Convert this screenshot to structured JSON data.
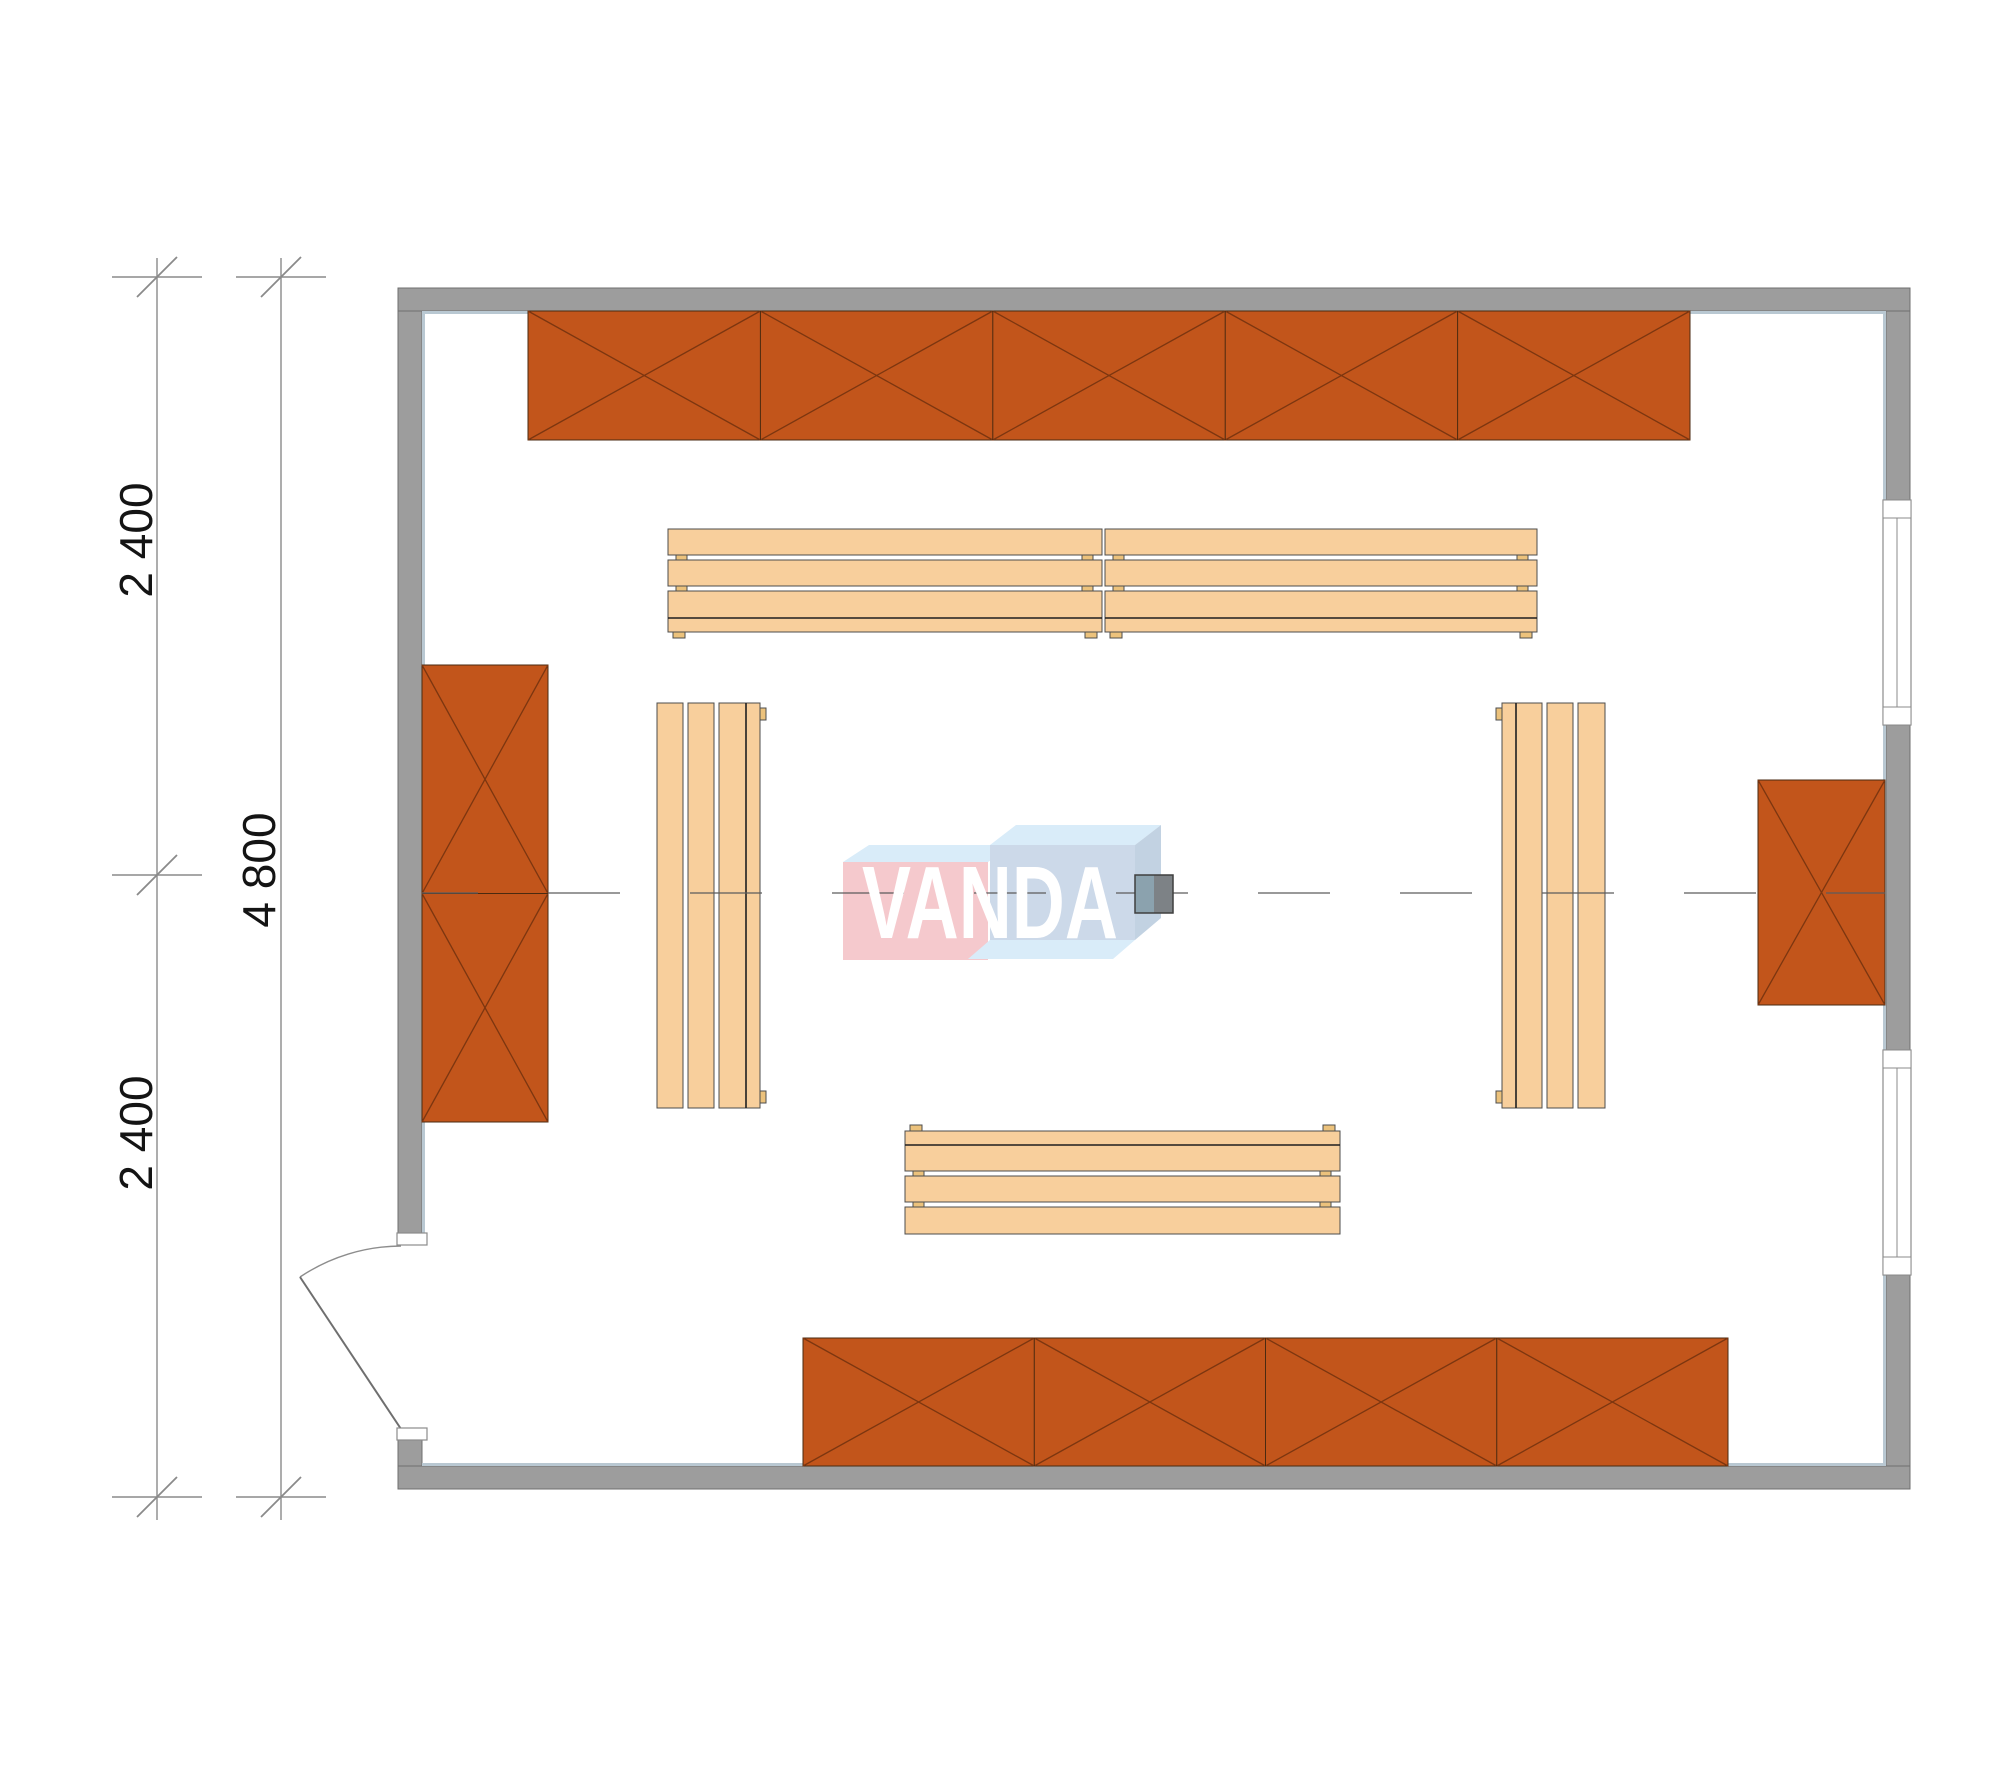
{
  "drawing": {
    "type": "architectural-floor-plan",
    "dimensions": {
      "top_segment": "2 400",
      "bottom_segment": "2 400",
      "total": "4 800"
    },
    "watermark": {
      "text": "VANDA"
    },
    "colors": {
      "wall": "#9d9d9d",
      "wall-outline": "#6f6f6f",
      "wall-highlight": "#b9c8d2",
      "frame-line": "#8b8b8b",
      "shelf": "#c2551b",
      "shelf-line": "#7c3610",
      "shelf-edge": "#4a2a10",
      "bench": "#f8cf9c",
      "bench-edge": "#4d4d4d",
      "feet": "#ecc27c",
      "dim": "#8a8a8a",
      "ink": "#141414",
      "centerline": "#5c5c5c",
      "wm-pink": "#f5c9cd",
      "wm-blue": "#ccd9e9",
      "wm-top": "#d9ecf9",
      "wm-side": "#c2d2e2",
      "column-left": "#8ba2ae",
      "column-right": "#7d8286"
    },
    "elements": {
      "shelves": [
        {
          "name": "shelf-top-wall",
          "x": 528,
          "y": 311,
          "w": 1162,
          "h": 129,
          "sections": 5,
          "dir": "h"
        },
        {
          "name": "shelf-left-wall",
          "x": 422,
          "y": 665,
          "w": 126,
          "h": 457,
          "sections": 2,
          "dir": "v"
        },
        {
          "name": "shelf-right-wall",
          "x": 1758,
          "y": 780,
          "w": 127,
          "h": 225,
          "sections": 1,
          "dir": "v"
        },
        {
          "name": "shelf-bottom-wall",
          "x": 803,
          "y": 1338,
          "w": 925,
          "h": 128,
          "sections": 4,
          "dir": "h"
        }
      ],
      "benches": [
        {
          "name": "bench-top-left",
          "x": 668,
          "y": 529,
          "len": 434,
          "dir": "h",
          "rail": "end"
        },
        {
          "name": "bench-top-right",
          "x": 1105,
          "y": 529,
          "len": 432,
          "dir": "h",
          "rail": "end"
        },
        {
          "name": "bench-bottom",
          "x": 905,
          "y": 1131,
          "len": 435,
          "dir": "h",
          "rail": "start"
        },
        {
          "name": "bench-left",
          "x": 657,
          "y": 703,
          "len": 405,
          "dir": "v",
          "rail": "end"
        },
        {
          "name": "bench-right",
          "x": 1502,
          "y": 703,
          "len": 405,
          "dir": "v",
          "rail": "start"
        }
      ],
      "column": {
        "x": 1135,
        "y": 875,
        "size": 38
      }
    }
  }
}
